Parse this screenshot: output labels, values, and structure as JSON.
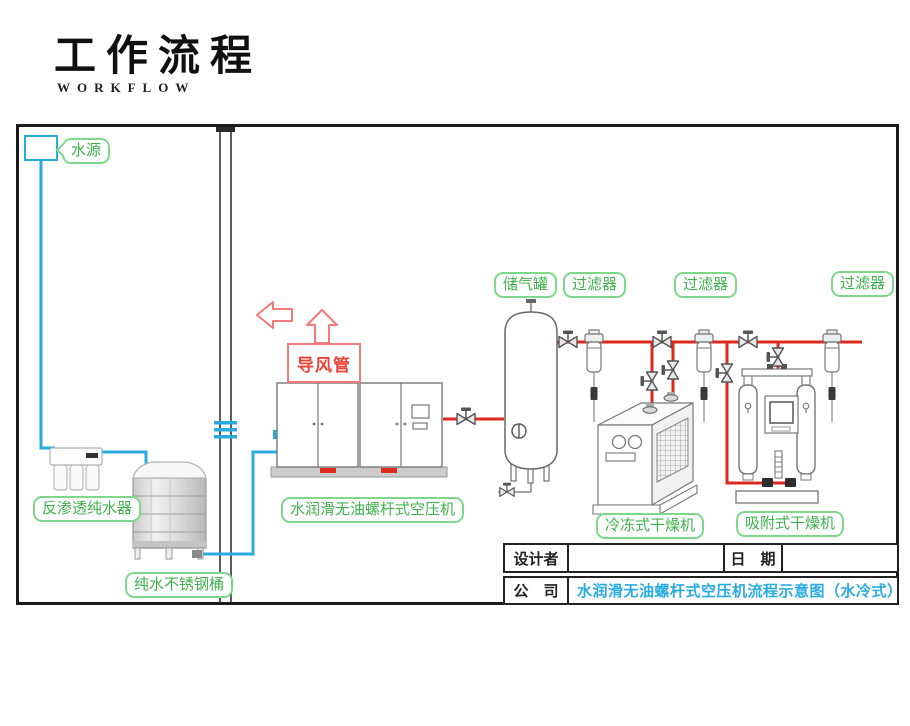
{
  "header": {
    "title": "工作流程",
    "subtitle": "WORKFLOW"
  },
  "diagram": {
    "labels": {
      "water_source": "水源",
      "air_duct": "导风管",
      "air_tank": "储气罐",
      "filter_1": "过滤器",
      "filter_2": "过滤器",
      "filter_3": "过滤器",
      "ro_purifier": "反渗透纯水器",
      "compressor": "水润滑无油螺杆式空压机",
      "steel_barrel": "纯水不锈钢桶",
      "refrigerated_dryer": "冷冻式干燥机",
      "adsorption_dryer": "吸附式干燥机"
    },
    "colors": {
      "water_pipe": "#29abe2",
      "air_pipe": "#dc2a1e",
      "label_green": "#3fb24e",
      "label_border": "#7ed889",
      "duct_red": "#e8453c",
      "title_blue": "#29abe2"
    }
  },
  "title_block": {
    "designer_label": "设计者",
    "designer_value": "",
    "date_label": "日　期",
    "date_value": "",
    "company_label": "公　司",
    "drawing_title": "水润滑无油螺杆式空压机流程示意图（水冷式）"
  }
}
